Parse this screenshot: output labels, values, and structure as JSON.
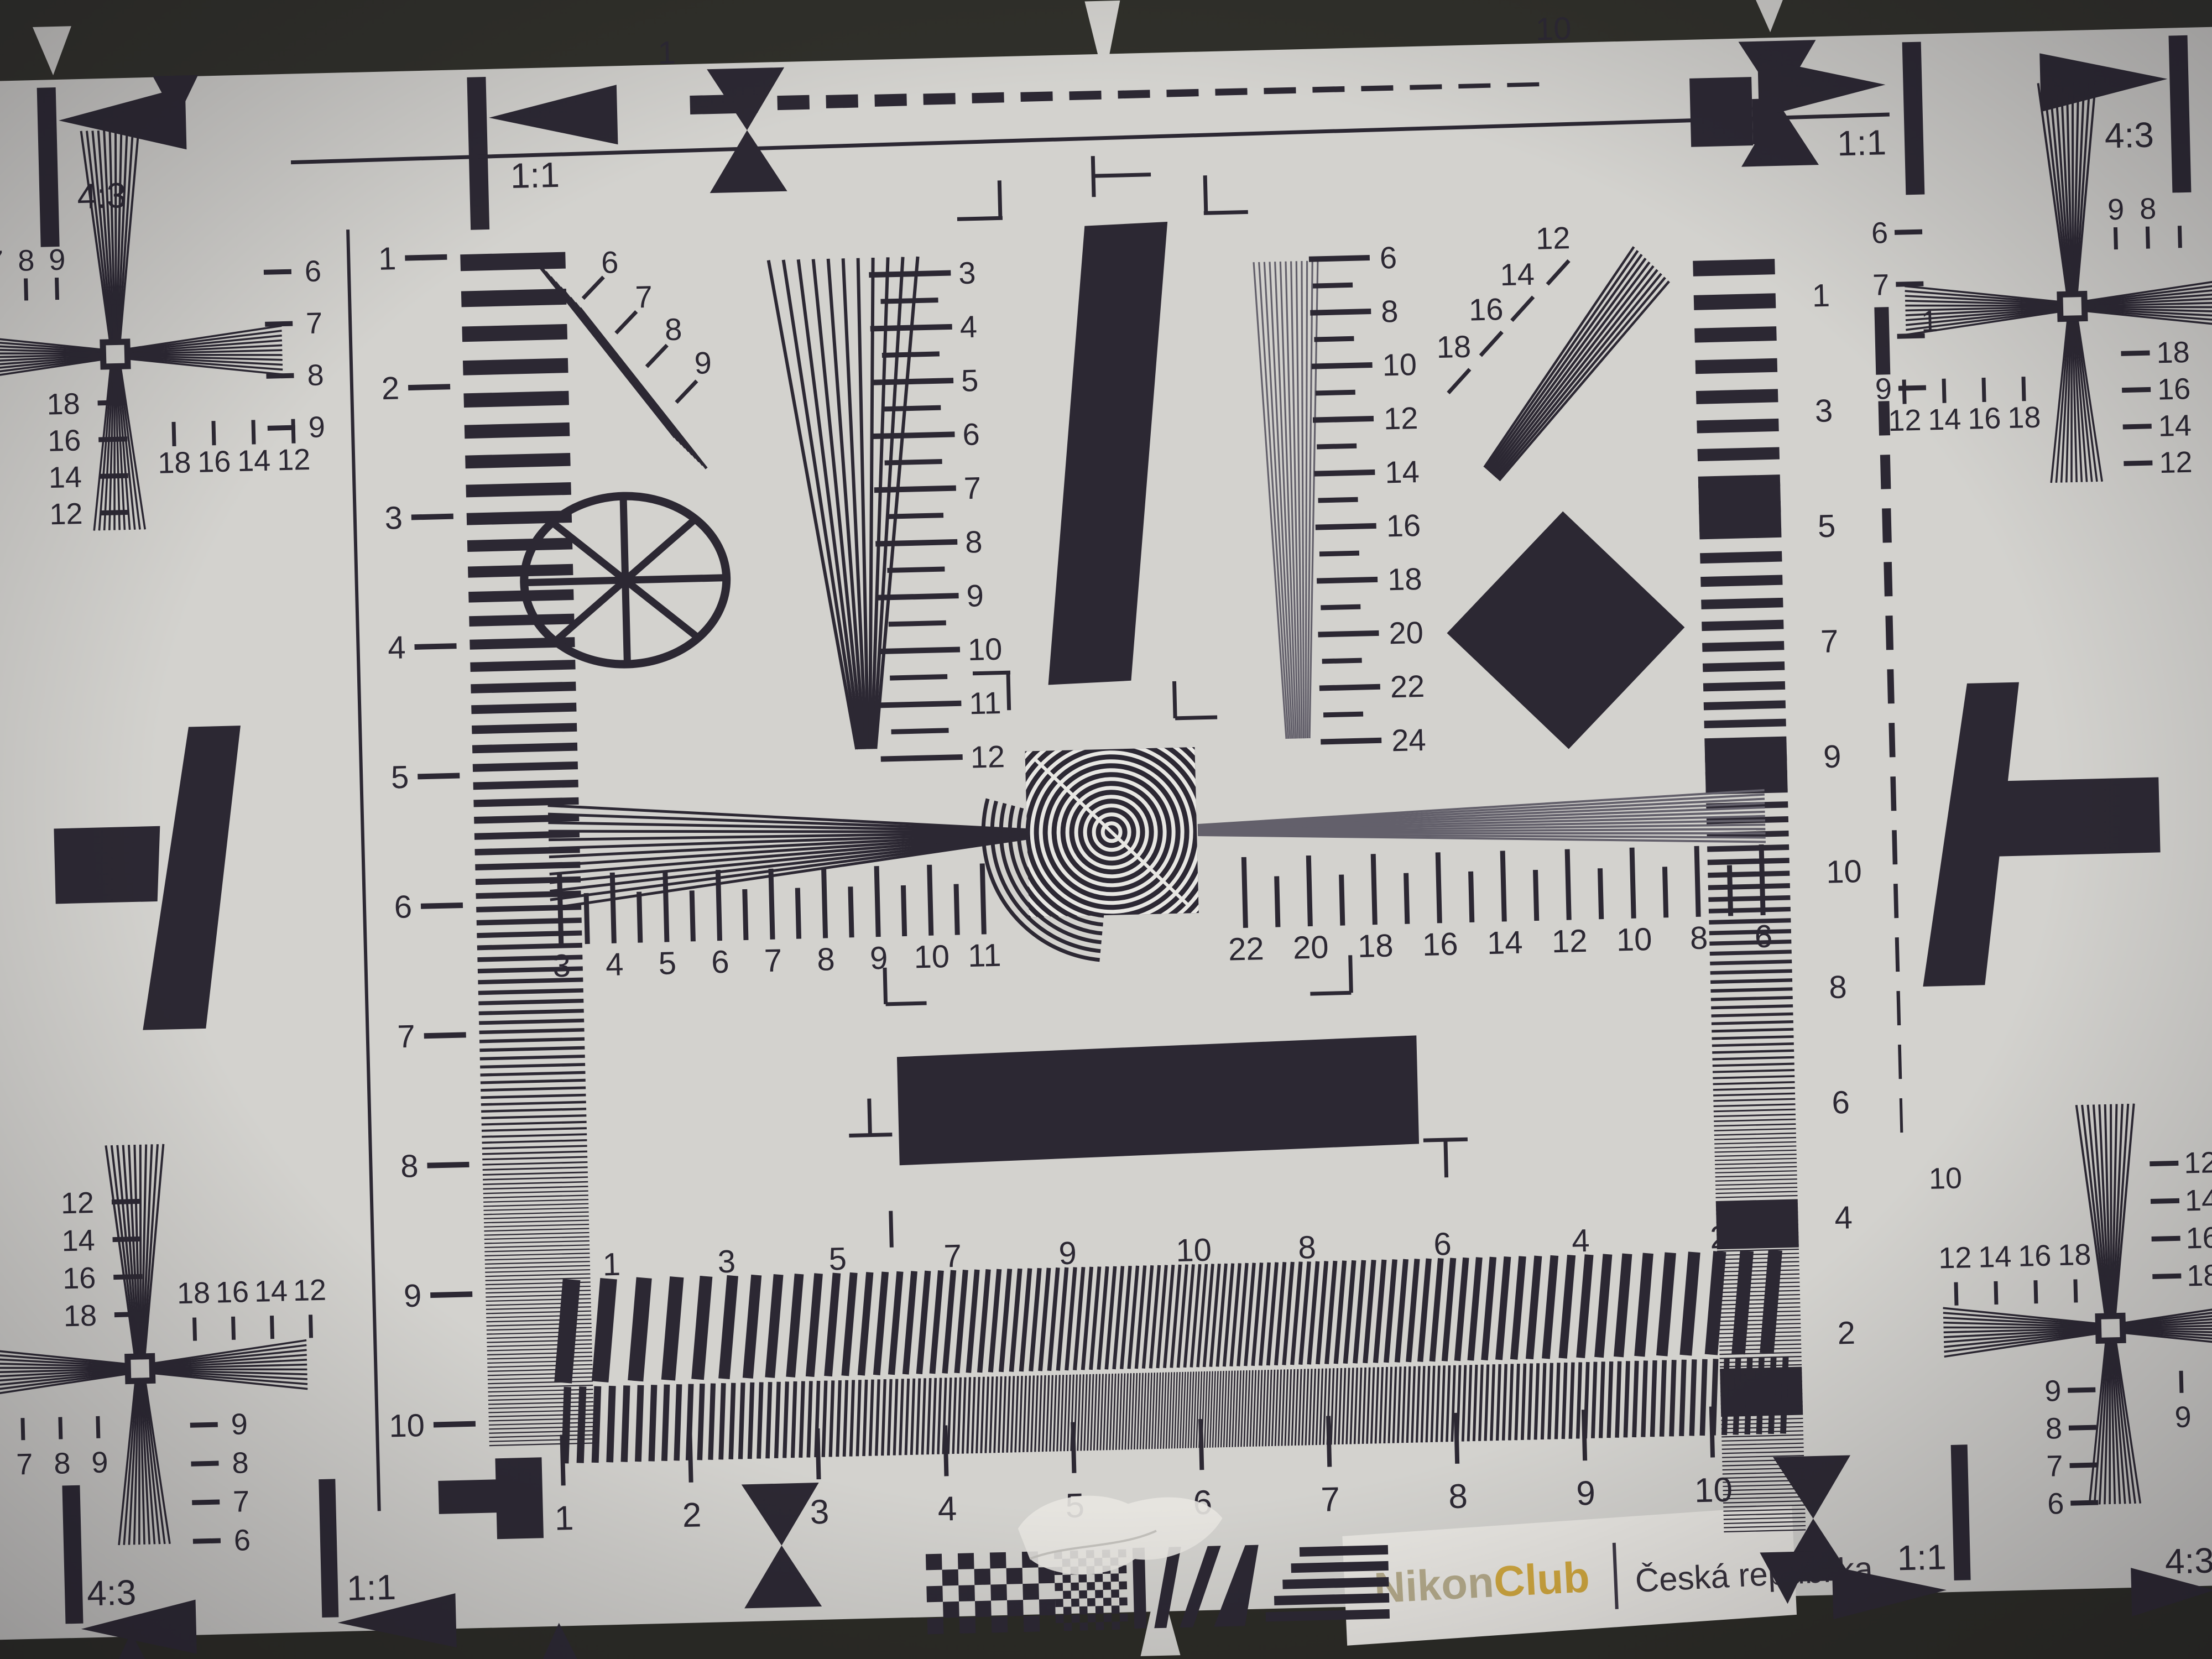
{
  "photo": {
    "description": "ISO 12233 style lens resolution test chart, photographed",
    "paper_color": "#d3d2ce",
    "ink_color": "#2c2833",
    "band_color": "#30302a",
    "accent_gold": "#d0a73e"
  },
  "brand": {
    "nikon": "Nikon",
    "club": "Club",
    "divider": "|",
    "region": "Česká republika"
  },
  "aspect_markers": {
    "tl_43": "4:3",
    "tl_11": "1:1",
    "tr_11": "1:1",
    "tr_43": "4:3",
    "bl_43": "4:3",
    "bl_11": "1:1",
    "br_11": "1:1",
    "br_43": "4:3"
  },
  "top_ruler": {
    "start": "1",
    "end": "10"
  },
  "right_dashed_ruler": {
    "start": "1",
    "end": "10"
  },
  "left_ruler": {
    "numbers": [
      "1",
      "2",
      "3",
      "4",
      "5",
      "6",
      "7",
      "8",
      "9",
      "10"
    ]
  },
  "right_column": {
    "numbers": [
      "1",
      "3",
      "5",
      "7",
      "9",
      "10",
      "8",
      "6",
      "4",
      "2"
    ]
  },
  "center_left_scale": {
    "numbers": [
      "3",
      "4",
      "5",
      "6",
      "7",
      "8",
      "9",
      "10",
      "11",
      "12"
    ]
  },
  "center_right_scale": {
    "numbers": [
      "6",
      "8",
      "10",
      "12",
      "14",
      "16",
      "18",
      "20",
      "22",
      "24"
    ]
  },
  "horiz_left_scale": {
    "numbers": [
      "3",
      "4",
      "5",
      "6",
      "7",
      "8",
      "9",
      "10",
      "11"
    ]
  },
  "horiz_right_scale": {
    "numbers": [
      "22",
      "20",
      "18",
      "16",
      "14",
      "12",
      "10",
      "8",
      "6"
    ]
  },
  "diag_fan_tl": {
    "numbers": [
      "6",
      "7",
      "8",
      "9"
    ]
  },
  "diag_fan_tr": {
    "numbers": [
      "12",
      "14",
      "16",
      "18"
    ]
  },
  "burst_scale": {
    "numbers": [
      "1",
      "3",
      "5",
      "7",
      "9",
      "10",
      "8",
      "6",
      "4",
      "2"
    ]
  },
  "bottom_ruler": {
    "numbers": [
      "1",
      "2",
      "3",
      "4",
      "5",
      "6",
      "7",
      "8",
      "9",
      "10"
    ]
  },
  "corners": {
    "tl": {
      "v_col": [
        "6",
        "7",
        "8",
        "9"
      ],
      "edge": [
        "7",
        "8",
        "9"
      ],
      "h_col": [
        "18",
        "16",
        "14",
        "12"
      ],
      "row": [
        "18",
        "16",
        "14",
        "12"
      ]
    },
    "tr": {
      "v_col": [
        "6",
        "7",
        "8",
        "9"
      ],
      "edge": [
        "9",
        "8"
      ],
      "h_col": [
        "18",
        "16",
        "14",
        "12"
      ],
      "row": [
        "12",
        "14",
        "16",
        "18"
      ]
    },
    "bl": {
      "h_col": [
        "12",
        "14",
        "16",
        "18"
      ],
      "row": [
        "18",
        "16",
        "14",
        "12"
      ],
      "v_col": [
        "9",
        "8",
        "7",
        "6"
      ],
      "edge": [
        "7",
        "8",
        "9"
      ]
    },
    "br": {
      "h_col": [
        "12",
        "14",
        "16",
        "18"
      ],
      "row": [
        "12",
        "14",
        "16",
        "18"
      ],
      "v_col": [
        "9",
        "8",
        "7",
        "6"
      ],
      "edge": [
        "9",
        "8"
      ]
    }
  }
}
